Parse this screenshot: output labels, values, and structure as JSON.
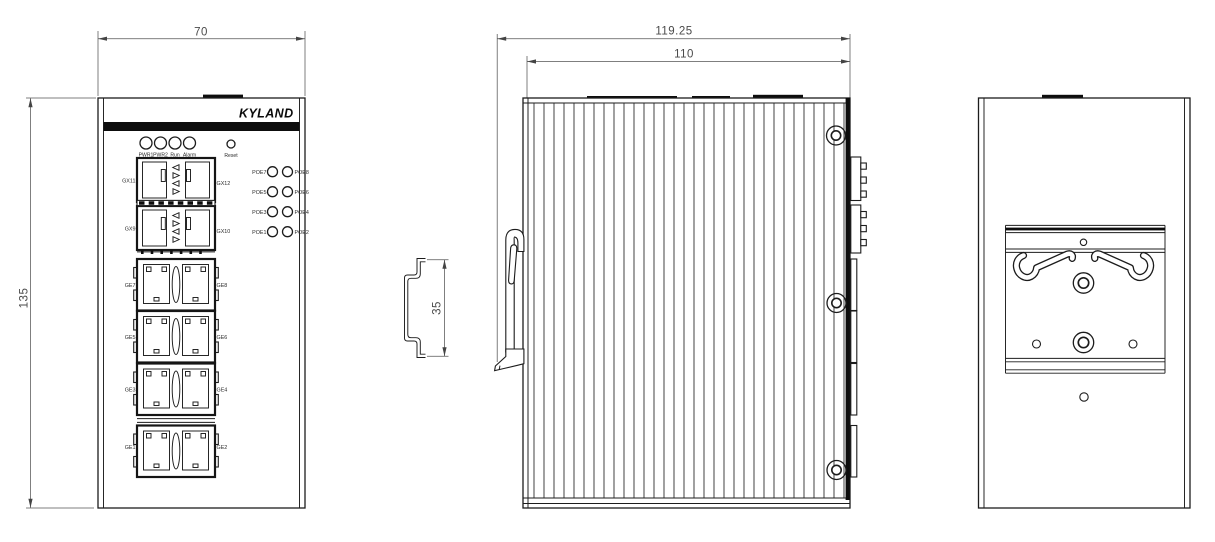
{
  "drawing": {
    "brand_logo": "KYLAND",
    "dimensions": {
      "front_width": "70",
      "front_height": "135",
      "side_overall_depth": "119.25",
      "side_body_depth": "110",
      "din_rail_height": "35"
    },
    "front_view": {
      "status_leds": [
        "PWR1",
        "PWR2",
        "Run",
        "Alarm"
      ],
      "reset_label": "Reset",
      "poe_rows": [
        {
          "left": "POE7",
          "right": "POE8"
        },
        {
          "left": "POE5",
          "right": "POE6"
        },
        {
          "left": "POE3",
          "right": "POE4"
        },
        {
          "left": "POE1",
          "right": "POE2"
        }
      ],
      "sfp_blocks": [
        {
          "left": "GX11",
          "right": "GX12"
        },
        {
          "left": "GX9",
          "right": "GX10"
        }
      ],
      "ge_blocks": [
        {
          "left": "GE7",
          "right": "GE8"
        },
        {
          "left": "GE5",
          "right": "GE6"
        },
        {
          "left": "GE3",
          "right": "GE4"
        },
        {
          "left": "GE1",
          "right": "GE2"
        }
      ]
    },
    "colors": {
      "line": "#1c1c1c",
      "dim_line": "#555555",
      "background": "#ffffff",
      "solid": "#0d0d0d"
    }
  }
}
